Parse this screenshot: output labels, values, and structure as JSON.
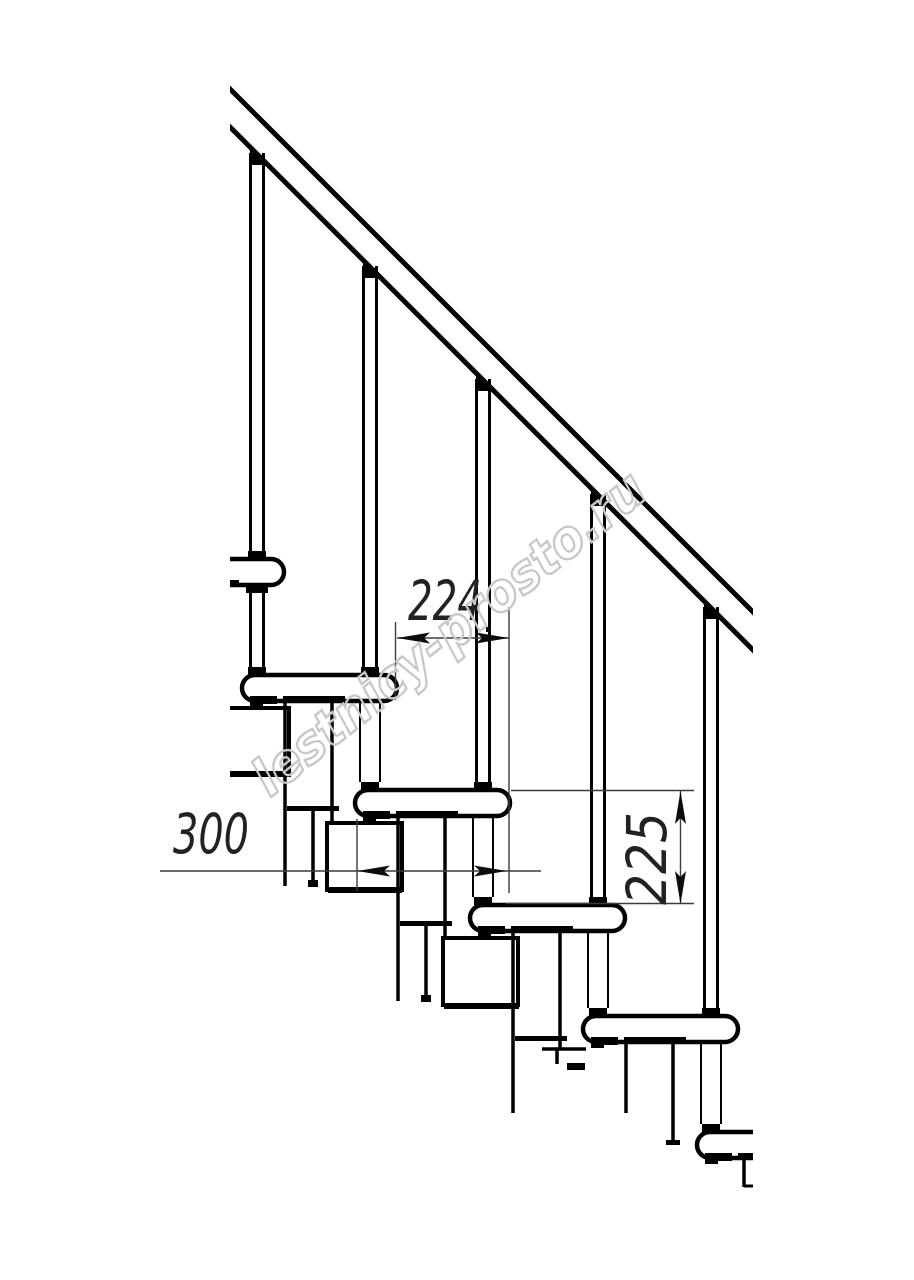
{
  "drawing": {
    "kind": "staircase side elevation, modular stair fragment",
    "watermark": {
      "text": "lestnicy-prosto.ru",
      "color": "#c8c8c8"
    },
    "dimensions": {
      "run": "224",
      "tread_depth": "300",
      "riser_height": "225"
    },
    "colors": {
      "line": "#000000",
      "dimension_line": "#3c3c3c",
      "background": "#ffffff"
    }
  }
}
